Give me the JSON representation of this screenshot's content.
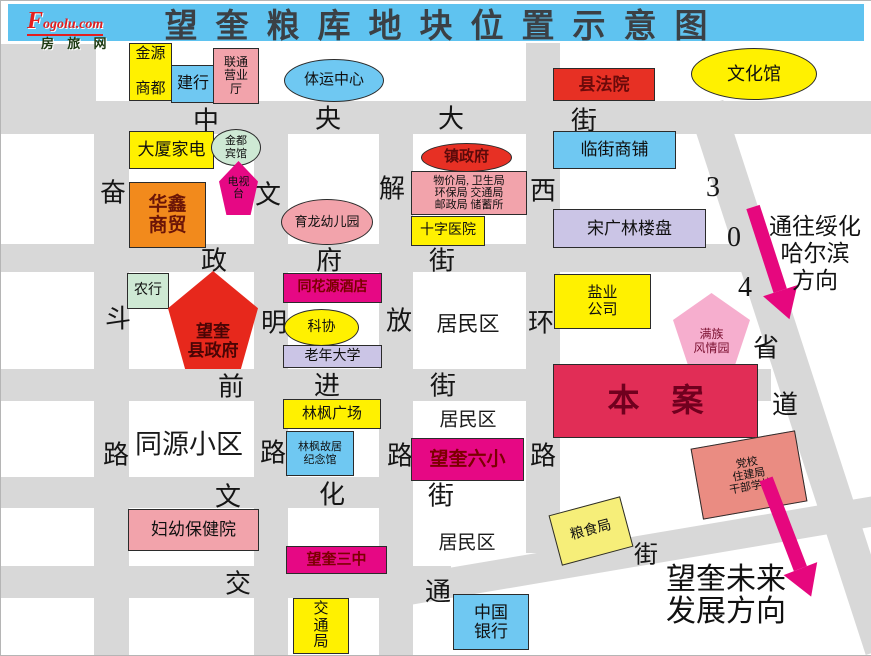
{
  "page": {
    "title": "望奎粮库地块位置示意图",
    "title_bg": "#5FC3F0"
  },
  "logo": {
    "brand_initial": "F",
    "brand_rest": "ogolu.com",
    "brand_cn": "房 旅 网"
  },
  "map": {
    "street_color": "#D8D8D8",
    "arrow_color": "#E6077E",
    "streets": [
      {
        "id": "zhongyang-dajie",
        "name": "中央大街",
        "x": 0,
        "y": 100,
        "w": 871,
        "h": 33
      },
      {
        "id": "zhengfu-jie",
        "name": "政府街",
        "x": 0,
        "y": 243,
        "w": 745,
        "h": 28
      },
      {
        "id": "qianjin-jie",
        "name": "前进街",
        "x": 0,
        "y": 368,
        "w": 770,
        "h": 32
      },
      {
        "id": "wenhua-jie",
        "name": "文化街",
        "x": 0,
        "y": 476,
        "w": 412,
        "h": 31
      },
      {
        "id": "jiaotong-jie",
        "name": "交通街",
        "x": 0,
        "y": 565,
        "w": 450,
        "h": 32
      },
      {
        "id": "fendou-lu",
        "name": "奋斗路",
        "x": 93,
        "y": 100,
        "w": 35,
        "h": 554
      },
      {
        "id": "wenming-lu",
        "name": "文明路",
        "x": 253,
        "y": 100,
        "w": 34,
        "h": 554
      },
      {
        "id": "jiefang-lu",
        "name": "解放路",
        "x": 378,
        "y": 100,
        "w": 34,
        "h": 554
      },
      {
        "id": "xihuan-lu",
        "name": "西环路",
        "x": 525,
        "y": 42,
        "w": 34,
        "h": 510
      },
      {
        "id": "northwest-corner-patch",
        "name": "",
        "x": 0,
        "y": 43,
        "w": 95,
        "h": 57
      },
      {
        "id": "shengdao-304",
        "name": "304省道",
        "x": 688,
        "y": 110,
        "w": 36,
        "h": 572,
        "rot": -18
      },
      {
        "id": "jiaotong-jie-diagonal",
        "name": "交通街斜段",
        "x": 400,
        "y": 575,
        "w": 500,
        "h": 30,
        "rot": -9.6
      }
    ],
    "street_chars": [
      {
        "c": "中",
        "x": 205,
        "y": 118
      },
      {
        "c": "央",
        "x": 327,
        "y": 116
      },
      {
        "c": "大",
        "x": 450,
        "y": 116
      },
      {
        "c": "街",
        "x": 583,
        "y": 118
      },
      {
        "c": "政",
        "x": 213,
        "y": 258
      },
      {
        "c": "府",
        "x": 328,
        "y": 258
      },
      {
        "c": "街",
        "x": 441,
        "y": 258
      },
      {
        "c": "前",
        "x": 230,
        "y": 384
      },
      {
        "c": "进",
        "x": 326,
        "y": 383
      },
      {
        "c": "街",
        "x": 442,
        "y": 383
      },
      {
        "c": "文",
        "x": 227,
        "y": 494
      },
      {
        "c": "化",
        "x": 331,
        "y": 492
      },
      {
        "c": "街",
        "x": 440,
        "y": 493
      },
      {
        "c": "交",
        "x": 237,
        "y": 581
      },
      {
        "c": "通",
        "x": 437,
        "y": 589
      },
      {
        "c": "街",
        "x": 645,
        "y": 551,
        "fs": 24
      },
      {
        "c": "奋",
        "x": 112,
        "y": 190
      },
      {
        "c": "斗",
        "x": 117,
        "y": 316
      },
      {
        "c": "路",
        "x": 115,
        "y": 452
      },
      {
        "c": "文",
        "x": 267,
        "y": 192
      },
      {
        "c": "明",
        "x": 273,
        "y": 320
      },
      {
        "c": "路",
        "x": 272,
        "y": 450
      },
      {
        "c": "解",
        "x": 391,
        "y": 186
      },
      {
        "c": "放",
        "x": 398,
        "y": 318
      },
      {
        "c": "路",
        "x": 399,
        "y": 453
      },
      {
        "c": "西",
        "x": 542,
        "y": 188
      },
      {
        "c": "环",
        "x": 540,
        "y": 320
      },
      {
        "c": "路",
        "x": 542,
        "y": 453
      },
      {
        "c": "3",
        "x": 712,
        "y": 187,
        "fs": 28
      },
      {
        "c": "0",
        "x": 733,
        "y": 237,
        "fs": 28
      },
      {
        "c": "4",
        "x": 744,
        "y": 287,
        "fs": 28
      },
      {
        "c": "省",
        "x": 765,
        "y": 345
      },
      {
        "c": "道",
        "x": 784,
        "y": 402
      }
    ],
    "blocks": [
      {
        "id": "jinyuan-shangdu",
        "lines": [
          "金源",
          "商都"
        ],
        "bg": "#FFF100",
        "x": 128,
        "y": 42,
        "w": 43,
        "h": 58,
        "fs": 15,
        "spread": true
      },
      {
        "id": "jianhang",
        "label": "建行",
        "bg": "#6FC8F2",
        "x": 170,
        "y": 64,
        "w": 44,
        "h": 38,
        "fs": 16
      },
      {
        "id": "liantong-yingyeting",
        "lines": [
          "联通",
          "营业",
          "厅"
        ],
        "bg": "#F2A3AB",
        "x": 212,
        "y": 47,
        "w": 46,
        "h": 56,
        "fs": 12
      },
      {
        "id": "tiyun-zhongxin",
        "label": "体运中心",
        "shape": "ellipse",
        "bg": "#6FC8F2",
        "x": 283,
        "y": 58,
        "w": 100,
        "h": 43,
        "fs": 15
      },
      {
        "id": "xian-fayuan",
        "label": "县法院",
        "bg": "#E73024",
        "fg": "#6B0A0A",
        "x": 552,
        "y": 67,
        "w": 102,
        "h": 33,
        "fs": 17,
        "bold": true
      },
      {
        "id": "wenhuaguan",
        "label": "文化馆",
        "shape": "ellipse",
        "bg": "#FFF100",
        "x": 690,
        "y": 47,
        "w": 126,
        "h": 52,
        "fs": 18
      },
      {
        "id": "dasha-jiadian",
        "label": "大厦家电",
        "bg": "#FFF100",
        "x": 128,
        "y": 130,
        "w": 85,
        "h": 38,
        "fs": 17
      },
      {
        "id": "jindu-binguan",
        "lines": [
          "金都",
          "宾馆"
        ],
        "shape": "ellipse",
        "bg": "#CEE9D4",
        "x": 210,
        "y": 128,
        "w": 50,
        "h": 37,
        "fs": 11
      },
      {
        "id": "dianshitai",
        "lines": [
          "电视",
          "台"
        ],
        "shape": "pentagon",
        "bg": "#E60884",
        "x": 218,
        "y": 160,
        "w": 39,
        "h": 54,
        "fs": 11
      },
      {
        "id": "huaxin-shangmao",
        "lines": [
          "华鑫",
          "商贸"
        ],
        "bg": "#F28A1C",
        "fg": "#6B1507",
        "x": 128,
        "y": 181,
        "w": 77,
        "h": 66,
        "fs": 19,
        "bold": true
      },
      {
        "id": "yulong-youeryuan",
        "label": "育龙幼儿园",
        "shape": "ellipse",
        "bg": "#F2A3AB",
        "x": 280,
        "y": 198,
        "w": 92,
        "h": 46,
        "fs": 13
      },
      {
        "id": "zhen-zhengfu",
        "label": "镇政府",
        "shape": "ellipse",
        "bg": "#E73024",
        "fg": "#5C0A0A",
        "x": 420,
        "y": 142,
        "w": 91,
        "h": 29,
        "fs": 15,
        "bold": true
      },
      {
        "id": "bureaus-block",
        "lines": [
          "物价局, 卫生局",
          "环保局 交通局",
          "邮政局 储蓄所"
        ],
        "bg": "#F2A3AB",
        "x": 410,
        "y": 170,
        "w": 116,
        "h": 44,
        "fs": 11
      },
      {
        "id": "shizi-yiyuan",
        "label": "十字医院",
        "bg": "#FFF100",
        "x": 410,
        "y": 215,
        "w": 74,
        "h": 30,
        "fs": 14
      },
      {
        "id": "linjie-shangpu",
        "label": "临街商铺",
        "bg": "#6FC8F2",
        "x": 552,
        "y": 130,
        "w": 123,
        "h": 38,
        "fs": 17
      },
      {
        "id": "songguanglin-loupan",
        "label": "宋广林楼盘",
        "bg": "#CBC5E6",
        "x": 552,
        "y": 208,
        "w": 153,
        "h": 39,
        "fs": 17
      },
      {
        "id": "nonghang",
        "label": "农行",
        "bg": "#CEE9D4",
        "x": 126,
        "y": 272,
        "w": 42,
        "h": 36,
        "fs": 14
      },
      {
        "id": "wangkui-xianzhengfu",
        "lines": [
          "望奎",
          "县政府"
        ],
        "shape": "pentagon",
        "bg": "#E7281C",
        "fg": "#4A0505",
        "x": 167,
        "y": 270,
        "w": 90,
        "h": 98,
        "fs": 17,
        "bold": true,
        "low": true
      },
      {
        "id": "tonghuayuan-jiudian",
        "label": "同花源酒店",
        "bg": "#E60884",
        "fg": "#7B0000",
        "x": 282,
        "y": 272,
        "w": 99,
        "h": 30,
        "fs": 14,
        "bold": true
      },
      {
        "id": "kexie",
        "label": "科协",
        "shape": "ellipse",
        "bg": "#FFF100",
        "x": 283,
        "y": 308,
        "w": 75,
        "h": 37,
        "fs": 14
      },
      {
        "id": "laonian-daxue",
        "label": "老年大学",
        "bg": "#CBC5E6",
        "x": 282,
        "y": 344,
        "w": 99,
        "h": 23,
        "fs": 14
      },
      {
        "id": "yanye-gongsi",
        "lines": [
          "盐业",
          "公司"
        ],
        "bg": "#FFF100",
        "x": 553,
        "y": 273,
        "w": 97,
        "h": 55,
        "fs": 15
      },
      {
        "id": "manzu-fengqingyuan",
        "lines": [
          "满族",
          "风情园"
        ],
        "shape": "pentagon",
        "bg": "#F6AECE",
        "fg": "#7B1030",
        "x": 672,
        "y": 292,
        "w": 77,
        "h": 71,
        "fs": 12,
        "low": true
      },
      {
        "id": "benan",
        "label": "本　案",
        "bg": "#E12D56",
        "fg": "#70001E",
        "x": 552,
        "y": 363,
        "w": 205,
        "h": 74,
        "fs": 32,
        "bold": true
      },
      {
        "id": "linfeng-guangchang",
        "label": "林枫广场",
        "bg": "#FFF100",
        "x": 282,
        "y": 398,
        "w": 98,
        "h": 30,
        "fs": 15
      },
      {
        "id": "linfeng-guju-jinianguan",
        "lines": [
          "林枫故居",
          "纪念馆"
        ],
        "bg": "#6FC8F2",
        "x": 285,
        "y": 430,
        "w": 68,
        "h": 45,
        "fs": 11
      },
      {
        "id": "wangkui-liuxiao",
        "label": "望奎六小",
        "bg": "#E60884",
        "fg": "#7B0000",
        "x": 410,
        "y": 437,
        "w": 113,
        "h": 43,
        "fs": 19,
        "bold": true
      },
      {
        "id": "dangxiao-zhujianju",
        "lines": [
          "党校",
          "住建局",
          "干部学校"
        ],
        "bg": "#EA8C82",
        "x": 695,
        "y": 438,
        "w": 106,
        "h": 72,
        "fs": 11,
        "rot": -10
      },
      {
        "id": "fuyou-baojianyuan",
        "label": "妇幼保健院",
        "bg": "#F2A3AB",
        "x": 127,
        "y": 508,
        "w": 131,
        "h": 42,
        "fs": 17
      },
      {
        "id": "wangkui-sanzhong",
        "label": "望奎三中",
        "bg": "#E60884",
        "fg": "#7B0000",
        "x": 285,
        "y": 545,
        "w": 101,
        "h": 28,
        "fs": 15,
        "bold": true
      },
      {
        "id": "liangshiju",
        "label": "粮食局",
        "bg": "#F6EE79",
        "x": 553,
        "y": 504,
        "w": 74,
        "h": 52,
        "fs": 14,
        "rot": -15
      },
      {
        "id": "jiaotongju",
        "lines": [
          "交",
          "通",
          "局"
        ],
        "bg": "#FFF100",
        "x": 292,
        "y": 597,
        "w": 56,
        "h": 56,
        "fs": 15
      },
      {
        "id": "zhongguo-yinhang",
        "lines": [
          "中国",
          "银行"
        ],
        "bg": "#6FC8F2",
        "x": 452,
        "y": 593,
        "w": 76,
        "h": 56,
        "fs": 17
      }
    ],
    "areas": [
      {
        "id": "juminqu-1",
        "label": "居民区",
        "x": 467,
        "y": 322,
        "fs": 21
      },
      {
        "id": "juminqu-2",
        "label": "居民区",
        "x": 467,
        "y": 417,
        "fs": 19
      },
      {
        "id": "juminqu-3",
        "label": "居民区",
        "x": 466,
        "y": 540,
        "fs": 19
      },
      {
        "id": "tongyuan-xiaoqu",
        "label": "同源小区",
        "x": 188,
        "y": 441,
        "fs": 27
      }
    ],
    "annotations": [
      {
        "id": "to-suihua-harbin",
        "lines": [
          "通往绥化",
          "哈尔滨",
          "方向"
        ],
        "x": 758,
        "y": 212,
        "w": 112,
        "fs": 23,
        "lh": 27
      },
      {
        "id": "wangkui-future",
        "lines": [
          "望奎未来",
          "发展方向"
        ],
        "x": 645,
        "y": 563,
        "w": 160,
        "fs": 30,
        "lh": 32
      }
    ],
    "arrows": [
      {
        "id": "to-suihua-arrow",
        "x": 752,
        "y": 206,
        "len": 118,
        "angle": -18
      },
      {
        "id": "future-direction-arrow",
        "x": 765,
        "y": 478,
        "len": 126,
        "angle": -21
      }
    ]
  }
}
